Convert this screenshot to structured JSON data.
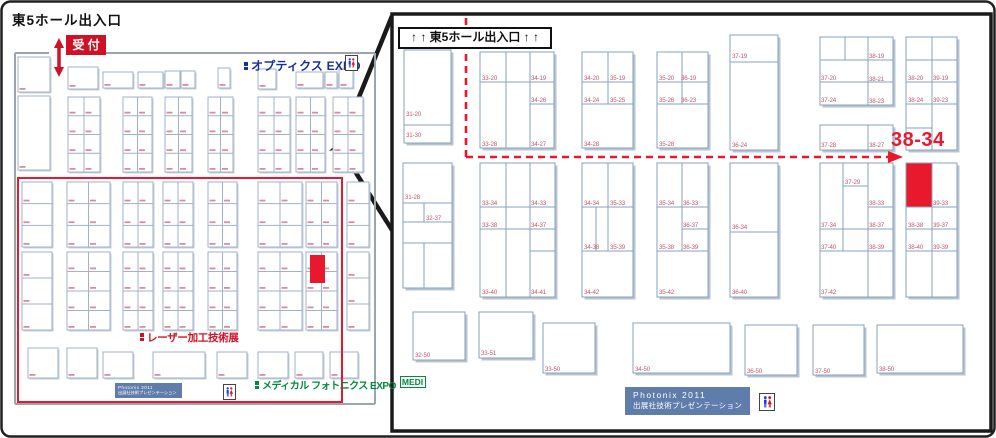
{
  "title": "東5ホール出入口",
  "reception_label": "受 付",
  "left_map": {
    "optics_expo_label": "オプティクス EXPO",
    "laser_expo_label": "レーザー加工技術展",
    "medical_expo_label": "メディカル フォトニクス EXPO",
    "medical_badge": "MEDI",
    "presentation_box": {
      "line1": "Photonix 2011",
      "line2": "出展社技術プレゼンテーション"
    },
    "geometry": {
      "boundary": [
        [
          15,
          53,
          49,
          53
        ],
        [
          67,
          53,
          375,
          53
        ],
        [
          15,
          53,
          15,
          404
        ],
        [
          15,
          404,
          375,
          404
        ],
        [
          375,
          53,
          375,
          404
        ]
      ],
      "plain_rects": [
        [
          18,
          57,
          32,
          35
        ],
        [
          18,
          96,
          32,
          74
        ],
        [
          68,
          67,
          30,
          22
        ],
        [
          103,
          72,
          30,
          16
        ],
        [
          138,
          72,
          25,
          16
        ],
        [
          165,
          71,
          15,
          17
        ],
        [
          181,
          71,
          14,
          17
        ],
        [
          218,
          68,
          12,
          20
        ],
        [
          258,
          69,
          18,
          20
        ],
        [
          296,
          72,
          27,
          16
        ],
        [
          325,
          72,
          12,
          16
        ],
        [
          339,
          69,
          14,
          19
        ],
        [
          28,
          348,
          30,
          30
        ],
        [
          67,
          348,
          30,
          30
        ],
        [
          103,
          352,
          30,
          26
        ],
        [
          153,
          352,
          52,
          26
        ],
        [
          217,
          352,
          30,
          26
        ],
        [
          258,
          352,
          30,
          26
        ],
        [
          295,
          352,
          28,
          26
        ],
        [
          330,
          352,
          28,
          26
        ]
      ],
      "grid_blocks": [
        [
          68,
          97,
          32,
          75,
          2,
          4
        ],
        [
          123,
          97,
          29,
          75,
          2,
          4
        ],
        [
          165,
          97,
          27,
          75,
          2,
          4
        ],
        [
          208,
          97,
          25,
          75,
          2,
          4
        ],
        [
          258,
          97,
          32,
          75,
          2,
          4
        ],
        [
          296,
          97,
          29,
          75,
          2,
          4
        ],
        [
          333,
          97,
          30,
          75,
          2,
          4
        ],
        [
          22,
          182,
          30,
          65,
          1,
          3
        ],
        [
          67,
          182,
          43,
          65,
          2,
          3
        ],
        [
          123,
          182,
          30,
          65,
          2,
          3
        ],
        [
          163,
          182,
          30,
          65,
          2,
          3
        ],
        [
          208,
          182,
          29,
          65,
          2,
          3
        ],
        [
          258,
          182,
          44,
          65,
          2,
          3
        ],
        [
          306,
          182,
          31,
          65,
          2,
          3
        ],
        [
          347,
          182,
          22,
          65,
          1,
          3
        ],
        [
          22,
          252,
          30,
          78,
          1,
          3
        ],
        [
          67,
          252,
          43,
          78,
          2,
          4
        ],
        [
          123,
          252,
          30,
          78,
          2,
          4
        ],
        [
          163,
          252,
          30,
          78,
          2,
          4
        ],
        [
          208,
          252,
          29,
          78,
          2,
          4
        ],
        [
          258,
          252,
          44,
          78,
          2,
          4
        ],
        [
          306,
          252,
          31,
          78,
          2,
          4
        ],
        [
          347,
          252,
          22,
          78,
          1,
          3
        ]
      ],
      "red_region": {
        "x": 18,
        "y": 178,
        "w": 324,
        "h": 224
      },
      "red_cell": {
        "x": 310,
        "y": 255,
        "w": 15,
        "h": 28
      }
    }
  },
  "right_map": {
    "entrance_banner": "↑ ↑ 東5ホール出入口 ↑ ↑",
    "featured_booth_label": "38-34",
    "presentation_box": {
      "line1": "Photonix  2011",
      "line2": "出展社技術プレゼンテーション"
    },
    "geometry": {
      "panel": {
        "x": 392,
        "y": 14,
        "w": 599,
        "h": 417
      },
      "blocks": [
        [
          404,
          50,
          47,
          93
        ],
        [
          480,
          52,
          74,
          96
        ],
        [
          582,
          52,
          51,
          96
        ],
        [
          657,
          52,
          51,
          96
        ],
        [
          730,
          35,
          48,
          115
        ],
        [
          820,
          37,
          73,
          68
        ],
        [
          820,
          125,
          73,
          25
        ],
        [
          906,
          37,
          51,
          113
        ],
        [
          403,
          163,
          49,
          125
        ],
        [
          480,
          163,
          75,
          134
        ],
        [
          582,
          163,
          51,
          134
        ],
        [
          657,
          163,
          51,
          134
        ],
        [
          730,
          163,
          48,
          134
        ],
        [
          820,
          163,
          73,
          134
        ],
        [
          906,
          163,
          51,
          134
        ],
        [
          413,
          312,
          52,
          48
        ],
        [
          479,
          312,
          54,
          46
        ],
        [
          543,
          323,
          52,
          50
        ],
        [
          633,
          323,
          97,
          50
        ],
        [
          745,
          325,
          52,
          50
        ],
        [
          813,
          325,
          51,
          50
        ],
        [
          877,
          325,
          86,
          48
        ]
      ],
      "inner_lines": [
        [
          404,
          125,
          451,
          125
        ],
        [
          506,
          52,
          506,
          148
        ],
        [
          530,
          52,
          530,
          148
        ],
        [
          480,
          82,
          554,
          82
        ],
        [
          530,
          104,
          554,
          104
        ],
        [
          608,
          52,
          608,
          104
        ],
        [
          582,
          82,
          633,
          82
        ],
        [
          582,
          104,
          633,
          104
        ],
        [
          682,
          52,
          682,
          104
        ],
        [
          657,
          82,
          708,
          82
        ],
        [
          657,
          104,
          708,
          104
        ],
        [
          730,
          62,
          778,
          62
        ],
        [
          845,
          37,
          845,
          60
        ],
        [
          868,
          37,
          868,
          105
        ],
        [
          820,
          60,
          893,
          60
        ],
        [
          820,
          82,
          893,
          82
        ],
        [
          868,
          125,
          868,
          150
        ],
        [
          932,
          37,
          932,
          150
        ],
        [
          906,
          60,
          957,
          60
        ],
        [
          906,
          82,
          957,
          82
        ],
        [
          906,
          104,
          957,
          104
        ],
        [
          906,
          128,
          932,
          128
        ],
        [
          403,
          203,
          452,
          203
        ],
        [
          403,
          222,
          452,
          222
        ],
        [
          403,
          243,
          452,
          243
        ],
        [
          424,
          203,
          424,
          222
        ],
        [
          424,
          243,
          424,
          288
        ],
        [
          506,
          163,
          506,
          297
        ],
        [
          530,
          163,
          530,
          297
        ],
        [
          480,
          207,
          555,
          207
        ],
        [
          480,
          229,
          555,
          229
        ],
        [
          530,
          251,
          555,
          251
        ],
        [
          608,
          163,
          608,
          251
        ],
        [
          596,
          207,
          596,
          251
        ],
        [
          582,
          207,
          633,
          207
        ],
        [
          582,
          251,
          633,
          251
        ],
        [
          682,
          163,
          682,
          251
        ],
        [
          657,
          207,
          708,
          207
        ],
        [
          682,
          229,
          708,
          229
        ],
        [
          657,
          251,
          708,
          251
        ],
        [
          730,
          232,
          778,
          232
        ],
        [
          843,
          163,
          843,
          251
        ],
        [
          868,
          163,
          868,
          297
        ],
        [
          843,
          186,
          868,
          186
        ],
        [
          868,
          207,
          893,
          207
        ],
        [
          820,
          229,
          893,
          229
        ],
        [
          820,
          251,
          893,
          251
        ],
        [
          932,
          163,
          932,
          297
        ],
        [
          906,
          207,
          957,
          207
        ],
        [
          906,
          229,
          957,
          229
        ],
        [
          906,
          251,
          957,
          251
        ]
      ],
      "red_cell": {
        "x": 906.5,
        "y": 163.5,
        "w": 25,
        "h": 43
      },
      "dashed_path": {
        "x": 466,
        "y_top": 18,
        "y_corner": 157,
        "x_end": 888,
        "arrow": "888,151 903,157 888,163"
      }
    },
    "booth_labels": [
      [
        "31-20",
        406,
        116
      ],
      [
        "31-30",
        406,
        137
      ],
      [
        "33-20",
        482,
        80
      ],
      [
        "34-19",
        531,
        80
      ],
      [
        "34-26",
        531,
        102
      ],
      [
        "33-28",
        482,
        146
      ],
      [
        "34-27",
        531,
        146
      ],
      [
        "34-20",
        584,
        80
      ],
      [
        "35-19",
        610,
        80
      ],
      [
        "34-24",
        584,
        102
      ],
      [
        "35-25",
        610,
        102
      ],
      [
        "34-28",
        584,
        146
      ],
      [
        "35-20",
        659,
        80
      ],
      [
        "36-19",
        681,
        80
      ],
      [
        "35-26",
        659,
        102
      ],
      [
        "36-23",
        681,
        102
      ],
      [
        "35-28",
        659,
        146
      ],
      [
        "37-19",
        732,
        58
      ],
      [
        "36-24",
        732,
        147
      ],
      [
        "38-19",
        869,
        58
      ],
      [
        "37-20",
        821,
        80
      ],
      [
        "38-21",
        869,
        81
      ],
      [
        "37-24",
        821,
        102
      ],
      [
        "38-23",
        869,
        103
      ],
      [
        "37-28",
        821,
        147
      ],
      [
        "38-27",
        869,
        147
      ],
      [
        "38-20",
        908,
        80
      ],
      [
        "39-19",
        933,
        80
      ],
      [
        "38-24",
        908,
        102
      ],
      [
        "39-23",
        933,
        102
      ],
      [
        "31-28",
        405,
        199
      ],
      [
        "32-37",
        426,
        220
      ],
      [
        "33-34",
        482,
        205
      ],
      [
        "34-33",
        531,
        205
      ],
      [
        "33-38",
        482,
        227
      ],
      [
        "34-37",
        531,
        227
      ],
      [
        "33-40",
        482,
        294
      ],
      [
        "34-41",
        531,
        294
      ],
      [
        "34-34",
        584,
        205
      ],
      [
        "35-33",
        610,
        205
      ],
      [
        "34-38",
        584,
        249
      ],
      [
        "35-39",
        610,
        249
      ],
      [
        "34-42",
        584,
        294
      ],
      [
        "35-34",
        659,
        205
      ],
      [
        "36-33",
        683,
        205
      ],
      [
        "36-37",
        683,
        227
      ],
      [
        "35-38",
        659,
        249
      ],
      [
        "36-39",
        683,
        249
      ],
      [
        "35-42",
        659,
        294
      ],
      [
        "36-34",
        732,
        229
      ],
      [
        "36-40",
        732,
        294
      ],
      [
        "37-29",
        845,
        184
      ],
      [
        "38-33",
        869,
        205
      ],
      [
        "37-34",
        821,
        227
      ],
      [
        "38-37",
        869,
        227
      ],
      [
        "37-40",
        821,
        249
      ],
      [
        "38-39",
        869,
        249
      ],
      [
        "37-42",
        821,
        294
      ],
      [
        "39-33",
        933,
        205
      ],
      [
        "38-38",
        908,
        227
      ],
      [
        "39-37",
        933,
        227
      ],
      [
        "38-40",
        908,
        249
      ],
      [
        "39-39",
        933,
        249
      ],
      [
        "32-50",
        415,
        357
      ],
      [
        "33-51",
        481,
        355
      ],
      [
        "33-50",
        545,
        371
      ],
      [
        "34-50",
        635,
        371
      ],
      [
        "36-50",
        747,
        373
      ],
      [
        "37-50",
        815,
        373
      ],
      [
        "38-50",
        879,
        371
      ]
    ]
  },
  "colors": {
    "dark": "#1a1a1a",
    "boundary": "#9aa5ad",
    "steel": "#87a0bc",
    "steel_light": "#9fb2c8",
    "shadow": "#b9c4d2",
    "shadow_light": "#c6cfda",
    "booth_text": "#c2596b",
    "booth_mark": "#d98e9b",
    "red": "#e8192c",
    "crimson": "#cf1126",
    "blue": "#1b2f9b",
    "green": "#008a3e",
    "pres_bg": "#5f7dab"
  }
}
